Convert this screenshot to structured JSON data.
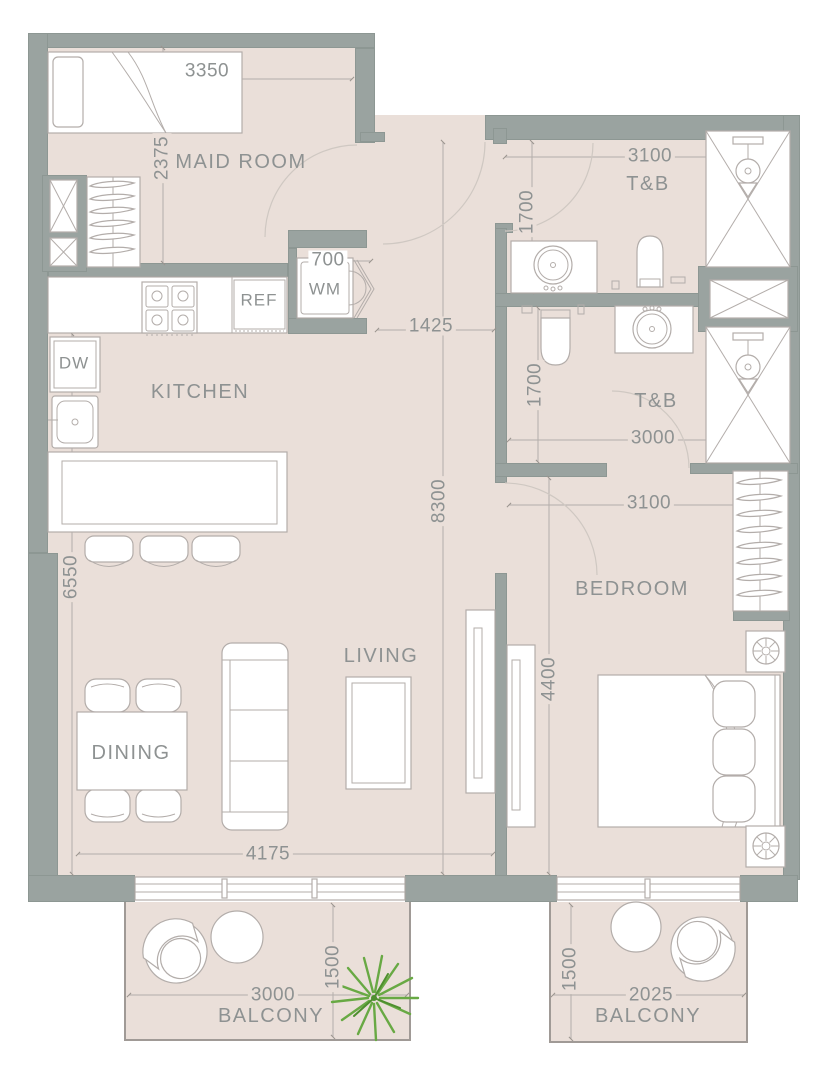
{
  "rooms": {
    "maid_room": "MAID ROOM",
    "tb_upper": "T&B",
    "tb_lower": "T&B",
    "kitchen": "KITCHEN",
    "living": "LIVING",
    "dining": "DINING",
    "bedroom": "BEDROOM",
    "balcony_left": "BALCONY",
    "balcony_right": "BALCONY"
  },
  "appliances": {
    "wm": "WM",
    "ref": "REF",
    "dw": "DW"
  },
  "dimensions": {
    "maid_width": "3350",
    "maid_depth": "2375",
    "tb_upper_width": "3100",
    "tb_upper_depth": "1700",
    "wm_width": "700",
    "hall_width": "1425",
    "tb_lower_depth": "1700",
    "tb_lower_width": "3000",
    "main_depth": "8300",
    "bedroom_width": "3100",
    "living_depth": "6550",
    "bedroom_depth": "4400",
    "living_width": "4175",
    "balcony_left_width": "3000",
    "balcony_left_depth": "1500",
    "balcony_right_width": "2025",
    "balcony_right_depth": "1500"
  },
  "colors": {
    "wall": "#9aa3a0",
    "wall_edge": "#8d9793",
    "floor": "#eadfd9",
    "line": "#b3adaa",
    "furniture": "#b3adaa",
    "text": "#8e9292",
    "plant": "#68a944"
  }
}
